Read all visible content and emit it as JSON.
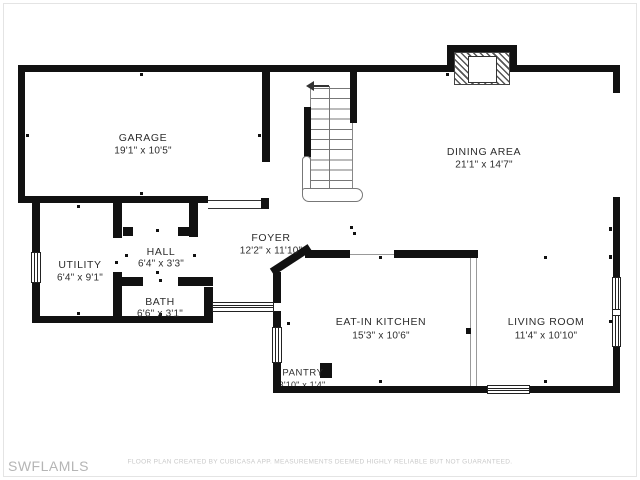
{
  "watermark": "SWFLAMLS",
  "disclaimer": "FLOOR PLAN CREATED BY CUBICASA APP. MEASUREMENTS DEEMED HIGHLY RELIABLE BUT NOT GUARANTEED.",
  "colors": {
    "wall": "#111111",
    "label_text": "#2d2d2d",
    "watermark_text": "#b5b5b5",
    "disclaimer_text": "#c9c9c9",
    "background": "#ffffff"
  },
  "rooms": [
    {
      "id": "garage",
      "name": "GARAGE",
      "dims": "19'1\" x 10'5\""
    },
    {
      "id": "dining-area",
      "name": "DINING AREA",
      "dims": "21'1\" x 14'7\""
    },
    {
      "id": "foyer",
      "name": "FOYER",
      "dims": "12'2\" x 11'10\""
    },
    {
      "id": "utility",
      "name": "UTILITY",
      "dims": "6'4\" x 9'1\""
    },
    {
      "id": "hall",
      "name": "HALL",
      "dims": "6'4\" x 3'3\""
    },
    {
      "id": "bath",
      "name": "BATH",
      "dims": "6'6\" x 3'1\""
    },
    {
      "id": "eat-in-kitchen",
      "name": "EAT-IN KITCHEN",
      "dims": "15'3\" x 10'6\""
    },
    {
      "id": "living-room",
      "name": "LIVING ROOM",
      "dims": "11'4\" x 10'10\""
    },
    {
      "id": "pantry",
      "name": "PANTRY",
      "dims": "3'10\" x 1'4\""
    }
  ],
  "features": {
    "staircase": "staircase-with-up-arrow",
    "fireplace": "fireplace-hatched",
    "windows": "double-line-window-symbols",
    "openings": "cased-opening-symbols"
  }
}
